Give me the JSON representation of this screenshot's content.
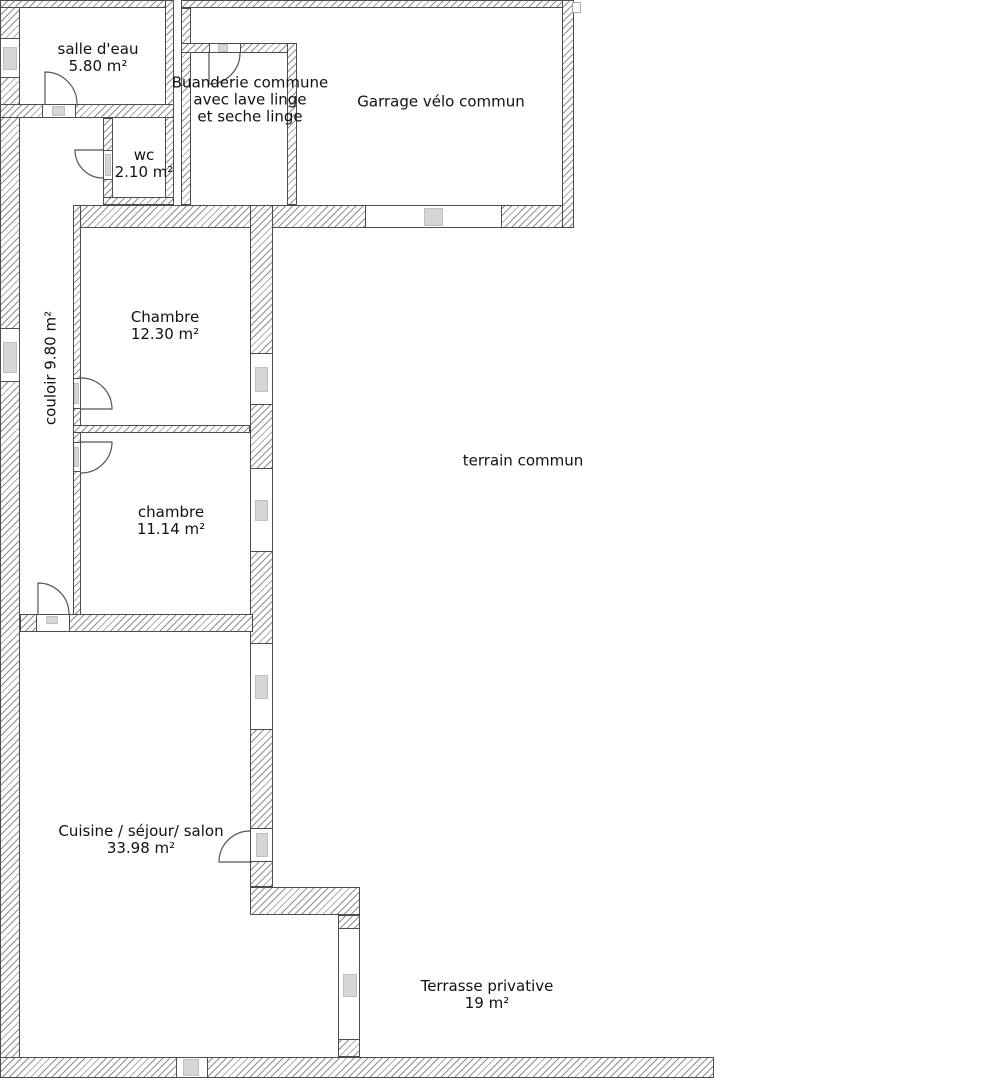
{
  "rooms": {
    "salle_deau": {
      "name": "salle d'eau",
      "area": "5.80 m²"
    },
    "buanderie": {
      "line1": "Buanderie commune",
      "line2": "avec lave linge",
      "line3": "et seche linge"
    },
    "garage": {
      "name": "Garrage vélo commun"
    },
    "wc": {
      "name": "wc",
      "area": "2.10 m²"
    },
    "couloir": {
      "name": "couloir 9.80 m²"
    },
    "chambre_1": {
      "name": "Chambre",
      "area": "12.30 m²"
    },
    "chambre_2": {
      "name": "chambre",
      "area": "11.14 m²"
    },
    "terrain": {
      "name": "terrain commun"
    },
    "cuisine": {
      "name": "Cuisine / séjour/ salon",
      "area": "33.98 m²"
    },
    "terrasse": {
      "name": "Terrasse privative",
      "area": "19 m²"
    }
  },
  "colors": {
    "background": "#ffffff",
    "text": "#111111",
    "wall_hatch": "#8f8f8f",
    "wall_outline": "#4d4d4d",
    "window_fill": "#d6d6d6",
    "window_border": "#bfbfbf",
    "door_stroke": "#555555"
  }
}
